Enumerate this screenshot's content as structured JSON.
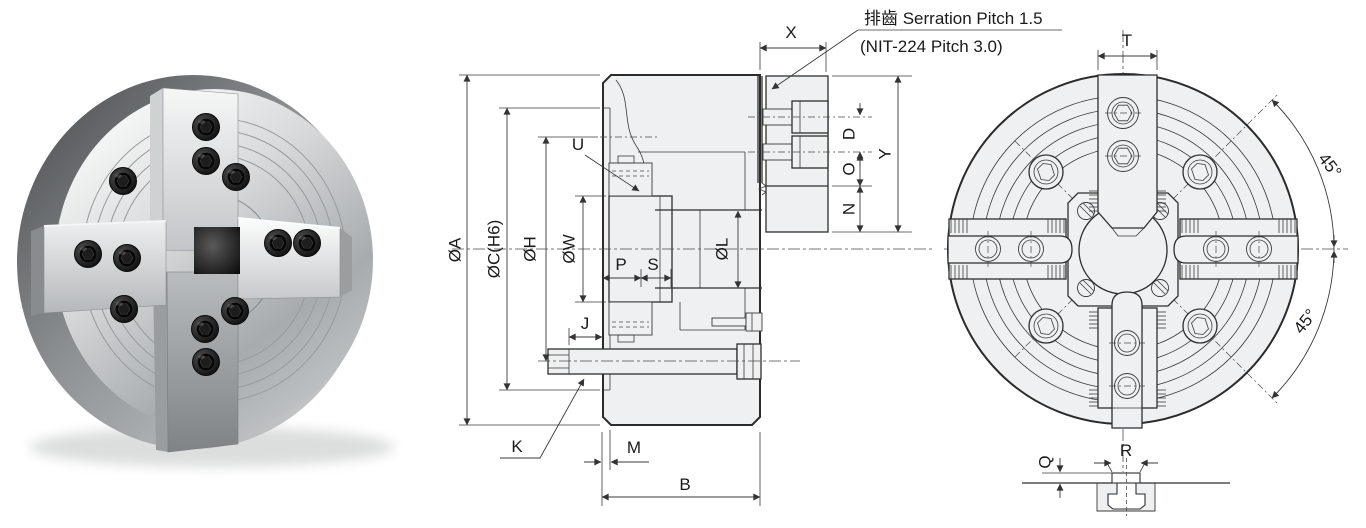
{
  "note": {
    "line1": "排齒 Serration Pitch 1.5",
    "line2": "(NIT-224 Pitch 3.0)"
  },
  "section": {
    "dia_a": "ØA",
    "dia_c": "ØC(H6)",
    "dia_h": "ØH",
    "dia_w": "ØW",
    "dia_l": "ØL",
    "u": "U",
    "p": "P",
    "s": "S",
    "j": "J",
    "k": "K",
    "m": "M",
    "b": "B",
    "x": "X",
    "d": "D",
    "o": "O",
    "n": "N",
    "y": "Y"
  },
  "front": {
    "t": "T",
    "angle_upper": "45°",
    "angle_lower": "45°"
  },
  "detail": {
    "r": "R",
    "q": "Q"
  },
  "colors": {
    "line": "#2b2b2b",
    "dim": "#3a3a3a",
    "fill": "#eef0f1",
    "background": "#ffffff"
  }
}
